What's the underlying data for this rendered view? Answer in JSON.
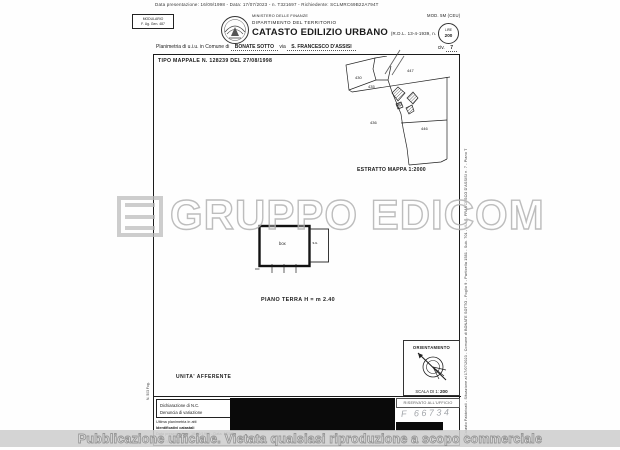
{
  "scan": {
    "top_line": "Data presentazione: 16/09/1998 - Data: 17/07/2023 - n. T321697 - Richiedente: SCLMRC69B22A794T"
  },
  "header": {
    "modulario_line1": "MODULARIO",
    "modulario_line2": "F. Ug. Gen. 487",
    "ministry": "MINISTERO DELLE FINANZE",
    "department": "DIPARTIMENTO DEL TERRITORIO",
    "title": "CATASTO EDILIZIO URBANO",
    "title_ref": "(R.D.L. 13-4-1939, n. 652)",
    "mod_label": "MOD. 5M (CEU)",
    "stamp_line1": "LIRE",
    "stamp_line2": "200",
    "planimetria_prefix": "Planimetria di u.i.u. in Comune di",
    "comune": "BONATE SOTTO",
    "via_label": "via",
    "via_value": "S. FRANCESCO D'ASSISI",
    "civ_label": "civ.",
    "civ_value": "7",
    "tipo_mappale": "TIPO MAPPALE N. 128239 DEL 27/08/1998"
  },
  "map": {
    "caption": "ESTRATTO MAPPA 1:2000",
    "parcels": [
      "430",
      "435",
      "447",
      "436",
      "446",
      "450"
    ]
  },
  "floor_plan": {
    "caption": "PIANO TERRA H = m 2.40",
    "room_label": "box",
    "annex_label": "s.u."
  },
  "sections": {
    "unita_afferente": "UNITA' AFFERENTE"
  },
  "orientation": {
    "title": "ORIENTAMENTO",
    "scale_label": "SCALA DI 1:",
    "scale_value": "200"
  },
  "footer": {
    "checkbox1_label": "Dichiarazione di N.C.",
    "checkbox1_glyph": "✕",
    "checkbox2_label": "Denuncia di  variazione",
    "micro1": "Ultima planimetria in atti",
    "micro2": "Identificativi catastali",
    "micro3": "Data presentazione: 16/09/1998 - Data: 17/07/2023",
    "fog_label": "Fog. n.",
    "fog_value": "1581",
    "part_label": "Part. n.",
    "part_value": "761",
    "riservato": "RISERVATO ALL'UFFICIO",
    "handwriting": "F 66734"
  },
  "margins": {
    "right_vertical": "Catasto Fabbricati - Situazione al 17/07/2023 - Comune di BONATE SOTTO - Foglio 9 - Particella 1581 - Sub. 701 - VIA S. FRANCESCO D'ASSISI n. 7 - Piano T",
    "left_vertical": "N. 503 Fog."
  },
  "watermark": {
    "text": "GRUPPO EDICOM",
    "band": "Pubblicazione ufficiale. Vietata qualsiasi riproduzione a scopo commerciale"
  },
  "colors": {
    "ink": "#1b1b1b",
    "watermark_gray": "#bcbcbc",
    "band_bg": "#cecece",
    "redaction_black": "#0a0a0a"
  }
}
